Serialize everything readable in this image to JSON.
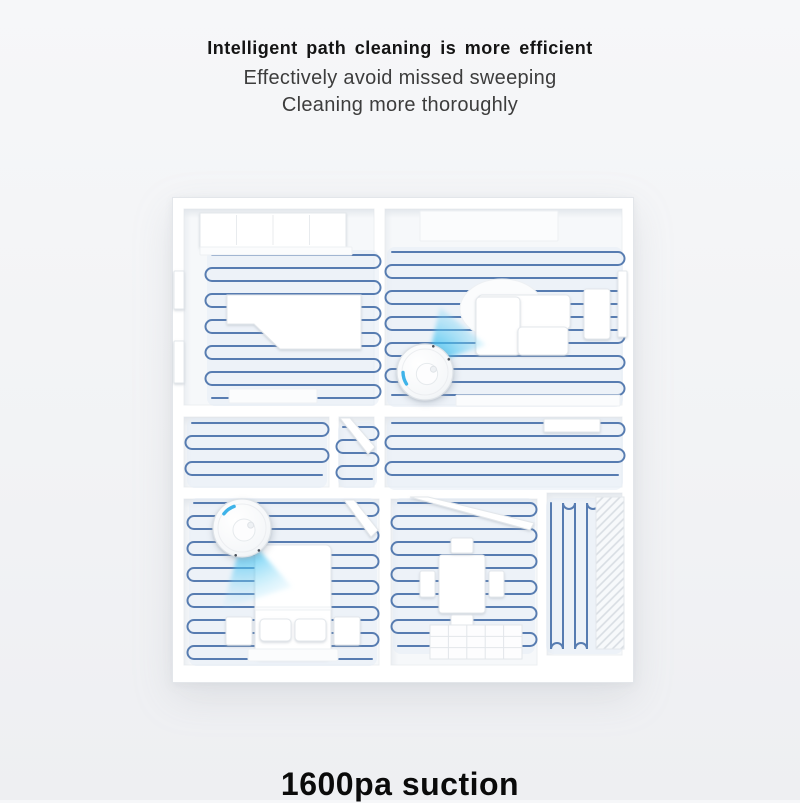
{
  "header": {
    "title": "Intelligent path cleaning is more efficient",
    "subtitle_line1": "Effectively avoid missed sweeping",
    "subtitle_line2": "Cleaning more thoroughly"
  },
  "footer": {
    "headline": "1600pa suction"
  },
  "illustration": {
    "alt": "Top-down 3D floor plan of an apartment; blue serpentine cleaning paths cover every room; two white robot vacuums with cyan lidar light cones clean the living room and the bedroom",
    "colors": {
      "house_fill": "#ffffff",
      "house_stroke": "#e3e6ea",
      "floor": "#f6f8fa",
      "floor_stroke": "#eceff2",
      "path_blue": "#4a72aa",
      "path_tint": "#e4ecf5",
      "cone_core": "#1fb4ef",
      "lidar_blue": "#3eb3e9"
    },
    "rooms": [
      {
        "id": "top-left",
        "x": 12,
        "y": 12,
        "w": 190,
        "h": 196
      },
      {
        "id": "top-right",
        "x": 213,
        "y": 12,
        "w": 237,
        "h": 196
      },
      {
        "id": "hall-left",
        "x": 12,
        "y": 220,
        "w": 145,
        "h": 70
      },
      {
        "id": "hall-mid",
        "x": 167,
        "y": 220,
        "w": 35,
        "h": 70
      },
      {
        "id": "hall-right",
        "x": 213,
        "y": 220,
        "w": 237,
        "h": 70
      },
      {
        "id": "bottom-left",
        "x": 12,
        "y": 302,
        "w": 195,
        "h": 166
      },
      {
        "id": "bottom-mid",
        "x": 219,
        "y": 302,
        "w": 146,
        "h": 166
      },
      {
        "id": "bottom-right",
        "x": 375,
        "y": 296,
        "w": 75,
        "h": 162
      }
    ],
    "paths": [
      {
        "room": "top-left",
        "x": 40,
        "y": 58,
        "w": 162,
        "h": 146,
        "s": 13,
        "o": "h"
      },
      {
        "room": "top-right",
        "x": 220,
        "y": 55,
        "w": 226,
        "h": 150,
        "s": 13,
        "o": "h"
      },
      {
        "room": "hall-left",
        "x": 20,
        "y": 226,
        "w": 130,
        "h": 60,
        "s": 13,
        "o": "h"
      },
      {
        "room": "hall-mid",
        "x": 171,
        "y": 230,
        "w": 29,
        "h": 56,
        "s": 13,
        "o": "h"
      },
      {
        "room": "hall-right",
        "x": 220,
        "y": 226,
        "w": 226,
        "h": 62,
        "s": 13,
        "o": "h"
      },
      {
        "room": "bottom-left",
        "x": 22,
        "y": 306,
        "w": 178,
        "h": 158,
        "s": 13,
        "o": "h"
      },
      {
        "room": "bottom-mid",
        "x": 226,
        "y": 306,
        "w": 132,
        "h": 146,
        "s": 13,
        "o": "h"
      },
      {
        "room": "bottom-right",
        "x": 379,
        "y": 306,
        "w": 67,
        "h": 146,
        "s": 12,
        "o": "v"
      }
    ],
    "furniture": [
      {
        "name": "wardrobe",
        "type": "panels",
        "x": 28,
        "y": 16,
        "w": 146,
        "h": 34,
        "n": 4
      },
      {
        "name": "wardrobe-shelf",
        "type": "rect",
        "x": 28,
        "y": 50,
        "w": 152,
        "h": 8,
        "tone": "faint"
      },
      {
        "name": "bed-desk",
        "type": "poly",
        "points": "55,98 189,98 189,152 108,152 82,127 55,127"
      },
      {
        "name": "floor-mat",
        "type": "rect",
        "x": 57,
        "y": 192,
        "w": 88,
        "h": 14,
        "tone": "faint"
      },
      {
        "name": "window-left-1",
        "type": "rect",
        "x": 2,
        "y": 74,
        "w": 10,
        "h": 38
      },
      {
        "name": "window-left-2",
        "type": "rect",
        "x": 2,
        "y": 144,
        "w": 10,
        "h": 42
      },
      {
        "name": "cabinet-top",
        "type": "rect",
        "x": 248,
        "y": 14,
        "w": 138,
        "h": 30,
        "tone": "faint"
      },
      {
        "name": "rug",
        "type": "ellipse",
        "cx": 330,
        "cy": 112,
        "rx": 42,
        "ry": 30,
        "tone": "faint"
      },
      {
        "name": "sofa-back",
        "type": "rect",
        "x": 306,
        "y": 98,
        "w": 92,
        "h": 34,
        "rx": 4
      },
      {
        "name": "sofa-chaise",
        "type": "rect",
        "x": 304,
        "y": 100,
        "w": 44,
        "h": 58,
        "rx": 4
      },
      {
        "name": "sofa-seat",
        "type": "rect",
        "x": 346,
        "y": 130,
        "w": 50,
        "h": 28,
        "rx": 4
      },
      {
        "name": "tv-stand",
        "type": "rect",
        "x": 412,
        "y": 92,
        "w": 26,
        "h": 50,
        "rx": 3
      },
      {
        "name": "window-right",
        "type": "rect",
        "x": 446,
        "y": 74,
        "w": 9,
        "h": 66
      },
      {
        "name": "shelf-strip",
        "type": "rect",
        "x": 284,
        "y": 198,
        "w": 164,
        "h": 11,
        "tone": "faint"
      },
      {
        "name": "hall-door",
        "type": "poly",
        "points": "168,221 178,221 203,250 196,257"
      },
      {
        "name": "hall-cabinet",
        "type": "rect",
        "x": 372,
        "y": 222,
        "w": 56,
        "h": 13
      },
      {
        "name": "bedroom-door",
        "type": "poly",
        "points": "172,303 182,303 206,333 199,340"
      },
      {
        "name": "bed",
        "type": "rect",
        "x": 83,
        "y": 348,
        "w": 76,
        "h": 114,
        "rx": 5
      },
      {
        "name": "blanket-line",
        "type": "rect",
        "x": 83,
        "y": 410,
        "w": 76,
        "h": 3,
        "tone": "faint"
      },
      {
        "name": "pillow-left",
        "type": "rect",
        "x": 88,
        "y": 422,
        "w": 31,
        "h": 22,
        "rx": 4
      },
      {
        "name": "pillow-right",
        "type": "rect",
        "x": 123,
        "y": 422,
        "w": 31,
        "h": 22,
        "rx": 4
      },
      {
        "name": "foot-mat",
        "type": "rect",
        "x": 76,
        "y": 452,
        "w": 90,
        "h": 12,
        "rx": 2,
        "tone": "faint"
      },
      {
        "name": "nightstand-left",
        "type": "rect",
        "x": 54,
        "y": 420,
        "w": 26,
        "h": 28,
        "rx": 2
      },
      {
        "name": "nightstand-right",
        "type": "rect",
        "x": 162,
        "y": 420,
        "w": 26,
        "h": 28,
        "rx": 2
      },
      {
        "name": "dining-door",
        "type": "poly",
        "points": "238,300 256,300 362,326 358,333"
      },
      {
        "name": "dining-table",
        "type": "rect",
        "x": 267,
        "y": 358,
        "w": 46,
        "h": 58,
        "rx": 3
      },
      {
        "name": "chair-top",
        "type": "rect",
        "x": 279,
        "y": 341,
        "w": 22,
        "h": 15,
        "rx": 2
      },
      {
        "name": "chair-bottom",
        "type": "rect",
        "x": 279,
        "y": 418,
        "w": 22,
        "h": 15,
        "rx": 2
      },
      {
        "name": "chair-left",
        "type": "rect",
        "x": 248,
        "y": 374,
        "w": 15,
        "h": 26,
        "rx": 2
      },
      {
        "name": "chair-right",
        "type": "rect",
        "x": 317,
        "y": 374,
        "w": 15,
        "h": 26,
        "rx": 2
      },
      {
        "name": "kitchen-tiles",
        "type": "tiles",
        "x": 258,
        "y": 428,
        "w": 92,
        "h": 34,
        "cols": 5,
        "rows": 3
      },
      {
        "name": "drying-rack",
        "type": "hatch",
        "x": 424,
        "y": 300,
        "w": 28,
        "h": 152
      }
    ],
    "robots": [
      {
        "id": "robot-living-room",
        "cx": 253,
        "cy": 175,
        "r": 28,
        "lidar": 163,
        "dots": [
          -28,
          -72
        ],
        "cone": "255,168 268,110 314,148"
      },
      {
        "id": "robot-bedroom",
        "cx": 70,
        "cy": 331,
        "r": 29,
        "lidar": 234,
        "dots": [
          53,
          103
        ],
        "cone": "72,336 50,412 120,390"
      }
    ]
  }
}
